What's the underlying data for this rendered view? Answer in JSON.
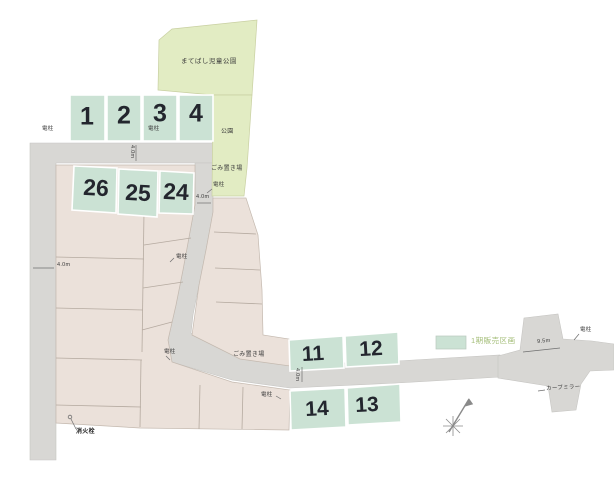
{
  "legend": {
    "phase1": "1期販売区画"
  },
  "park": {
    "name": "まてばし児童公園",
    "label": "公園"
  },
  "annotations": {
    "garbage": "ごみ置き場",
    "pole": "電柱",
    "hydrant": "消火栓",
    "curve_mirror": "カーブミラー"
  },
  "dimensions": {
    "road_4m": "4.0m",
    "road_9_5m": "9.5m"
  },
  "lots": [
    "1",
    "2",
    "3",
    "4",
    "26",
    "25",
    "24",
    "11",
    "12",
    "14",
    "13"
  ],
  "colors": {
    "phase1_lot": "#cbe2d4",
    "park": "#e2ecc3",
    "other_lot": "#ebe1da",
    "road": "#d8d7d4",
    "legend_text": "#a3bd77",
    "lot_number": "#23262e"
  }
}
